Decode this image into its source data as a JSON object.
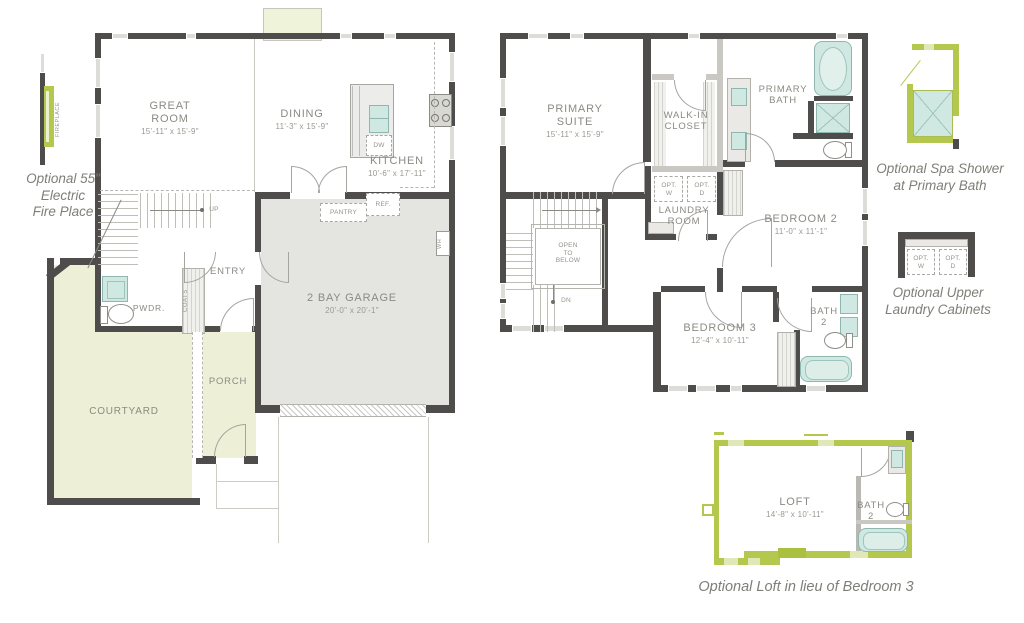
{
  "title": "Two-story floor plan with options",
  "colors": {
    "wall": "#4e4d4b",
    "optional_green": "#b5c84e",
    "green_fill": "#edf0d6",
    "garage_fill": "#e4e4e1",
    "fixture_teal": "#cfe8e2",
    "label_gray": "#8b8a83",
    "caption_gray": "#7f7e77"
  },
  "floor1": {
    "rooms": {
      "great_room": {
        "name": "GREAT ROOM",
        "dims": "15'-11\" x 15'-9\""
      },
      "dining": {
        "name": "DINING",
        "dims": "11'-3\" x 15'-9\""
      },
      "kitchen": {
        "name": "KITCHEN",
        "dims": "10'-6\" x 17'-11\""
      },
      "garage": {
        "name": "2 BAY GARAGE",
        "dims": "20'-0\" x 20'-1\""
      },
      "entry": {
        "name": "ENTRY"
      },
      "pwdr": {
        "name": "PWDR."
      },
      "porch": {
        "name": "PORCH"
      },
      "courtyard": {
        "name": "COURTYARD"
      }
    },
    "labels": {
      "pantry": "PANTRY",
      "ref": "REF.",
      "dw": "DW",
      "wh": "WH",
      "coats": "COATS",
      "up": "UP"
    }
  },
  "floor2": {
    "rooms": {
      "primary_suite": {
        "name": "PRIMARY SUITE",
        "dims": "15'-11\" x 15'-9\""
      },
      "walk_in_closet": {
        "name": "WALK-IN CLOSET"
      },
      "primary_bath": {
        "name": "PRIMARY BATH"
      },
      "laundry_room": {
        "name": "LAUNDRY ROOM"
      },
      "bedroom2": {
        "name": "BEDROOM 2",
        "dims": "11'-0\" x 11'-1\""
      },
      "bedroom3": {
        "name": "BEDROOM 3",
        "dims": "12'-4\" x 10'-11\""
      },
      "bath2": {
        "name": "BATH 2"
      }
    },
    "labels": {
      "open_to_below": "OPEN TO BELOW",
      "dn": "DN",
      "opt_w": "OPT. W",
      "opt_d": "OPT. D"
    }
  },
  "options": {
    "fireplace": {
      "caption_lines": [
        "Optional 55\"",
        "Electric",
        "Fire Place"
      ],
      "icon_label": "FIREPLACE"
    },
    "spa_shower": {
      "caption_lines": [
        "Optional Spa Shower",
        "at Primary Bath"
      ]
    },
    "laundry_cabinets": {
      "caption_lines": [
        "Optional Upper",
        "Laundry Cabinets"
      ],
      "opt_w": "OPT. W",
      "opt_d": "OPT. D"
    },
    "loft": {
      "rooms": {
        "loft": {
          "name": "LOFT",
          "dims": "14'-8\" x 10'-11\""
        },
        "bath2": {
          "name": "BATH 2"
        }
      },
      "caption": "Optional Loft in lieu of Bedroom 3"
    }
  }
}
